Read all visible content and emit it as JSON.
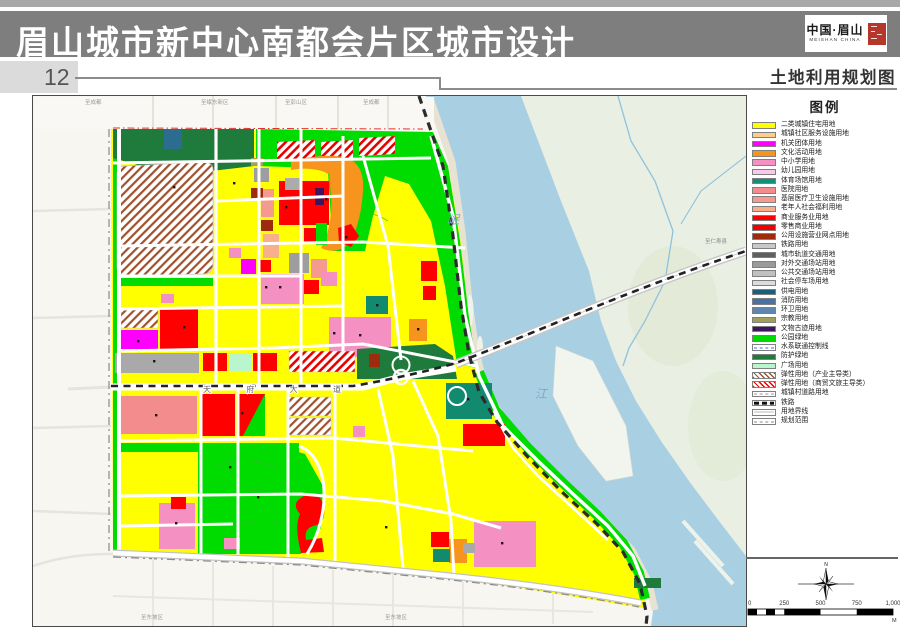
{
  "page": {
    "title_bar": "眉山城市新中心南都会片区城市设计",
    "page_number": "12",
    "sheet_title": "土地利用规划图"
  },
  "logo": {
    "cn": "中国·眉山",
    "en": "MEISHAN CHINA"
  },
  "legend": {
    "title": "图例",
    "items": [
      {
        "label": "二类城镇住宅用地",
        "type": "fill",
        "color": "#FFFF00"
      },
      {
        "label": "城镇社区服务设施用地",
        "type": "fill",
        "color": "#FBCE8F"
      },
      {
        "label": "机关团体用地",
        "type": "fill",
        "color": "#FF00FF"
      },
      {
        "label": "文化活动用地",
        "type": "fill",
        "color": "#F7941D"
      },
      {
        "label": "中小学用地",
        "type": "fill",
        "color": "#F591C2"
      },
      {
        "label": "幼儿园用地",
        "type": "fill",
        "color": "#FBC7EA"
      },
      {
        "label": "体育场馆用地",
        "type": "fill",
        "color": "#0E9178"
      },
      {
        "label": "医院用地",
        "type": "fill",
        "color": "#F38C8C"
      },
      {
        "label": "基层医疗卫生设施用地",
        "type": "fill",
        "color": "#F59A8F"
      },
      {
        "label": "老年人社会福利用地",
        "type": "fill",
        "color": "#F8B08C"
      },
      {
        "label": "商业服务业用地",
        "type": "fill",
        "color": "#FF0000"
      },
      {
        "label": "零售商业用地",
        "type": "fill",
        "color": "#F40000"
      },
      {
        "label": "公用设施营业网点用地",
        "type": "fill",
        "color": "#9E2B0E"
      },
      {
        "label": "铁路用地",
        "type": "fill",
        "color": "#C8C8C8"
      },
      {
        "label": "城市轨道交通用地",
        "type": "fill",
        "color": "#5F5F5F"
      },
      {
        "label": "对外交通场站用地",
        "type": "fill",
        "color": "#9A9A9A"
      },
      {
        "label": "公共交通场站用地",
        "type": "fill",
        "color": "#C0C0C0"
      },
      {
        "label": "社会停车场用地",
        "type": "fill",
        "color": "#DCDCDC"
      },
      {
        "label": "供电用地",
        "type": "fill",
        "color": "#1B5F78"
      },
      {
        "label": "消防用地",
        "type": "fill",
        "color": "#4A72A0"
      },
      {
        "label": "环卫用地",
        "type": "fill",
        "color": "#5F86AE"
      },
      {
        "label": "宗教用地",
        "type": "fill",
        "color": "#9FA05A"
      },
      {
        "label": "文物古迹用地",
        "type": "fill",
        "color": "#3F1460"
      },
      {
        "label": "公园绿地",
        "type": "fill",
        "color": "#00DC00"
      },
      {
        "label": "水系联通控制线",
        "type": "waterline",
        "color": "#3A6FD8"
      },
      {
        "label": "防护绿地",
        "type": "fill",
        "color": "#1E7B3C"
      },
      {
        "label": "广场用地",
        "type": "fill",
        "color": "#B9F6CE"
      },
      {
        "label": "弹性用地（产业主导类）",
        "type": "hatch",
        "color": "#A0522D"
      },
      {
        "label": "弹性用地（商贸文旅主导类）",
        "type": "hatch",
        "color": "#E60000"
      },
      {
        "label": "城镇村道路用地",
        "type": "ticks",
        "color": "#9A9A9A"
      },
      {
        "label": "铁路",
        "type": "rail",
        "color": "#111111"
      },
      {
        "label": "用地界线",
        "type": "thinline",
        "color": "#BBBBBB"
      },
      {
        "label": "规划范围",
        "type": "dashdot",
        "color": "#8A8A8A"
      }
    ]
  },
  "map_labels": {
    "river_top": "岷",
    "river_bottom": "江",
    "avenue": "天府大道",
    "to_chengdu_left": "至成都",
    "to_mindong": "至岷东新区",
    "to_pengshan": "至彭山区",
    "to_chengdu_right": "至成都",
    "to_renshou": "至仁寿县",
    "to_dongpo_1": "至东坡区",
    "to_dongpo_2": "至东坡区"
  },
  "north": {
    "label": "N"
  },
  "scale_bar": {
    "ticks": [
      "0",
      "250",
      "500",
      "750",
      "1,000"
    ],
    "unit": "M"
  }
}
